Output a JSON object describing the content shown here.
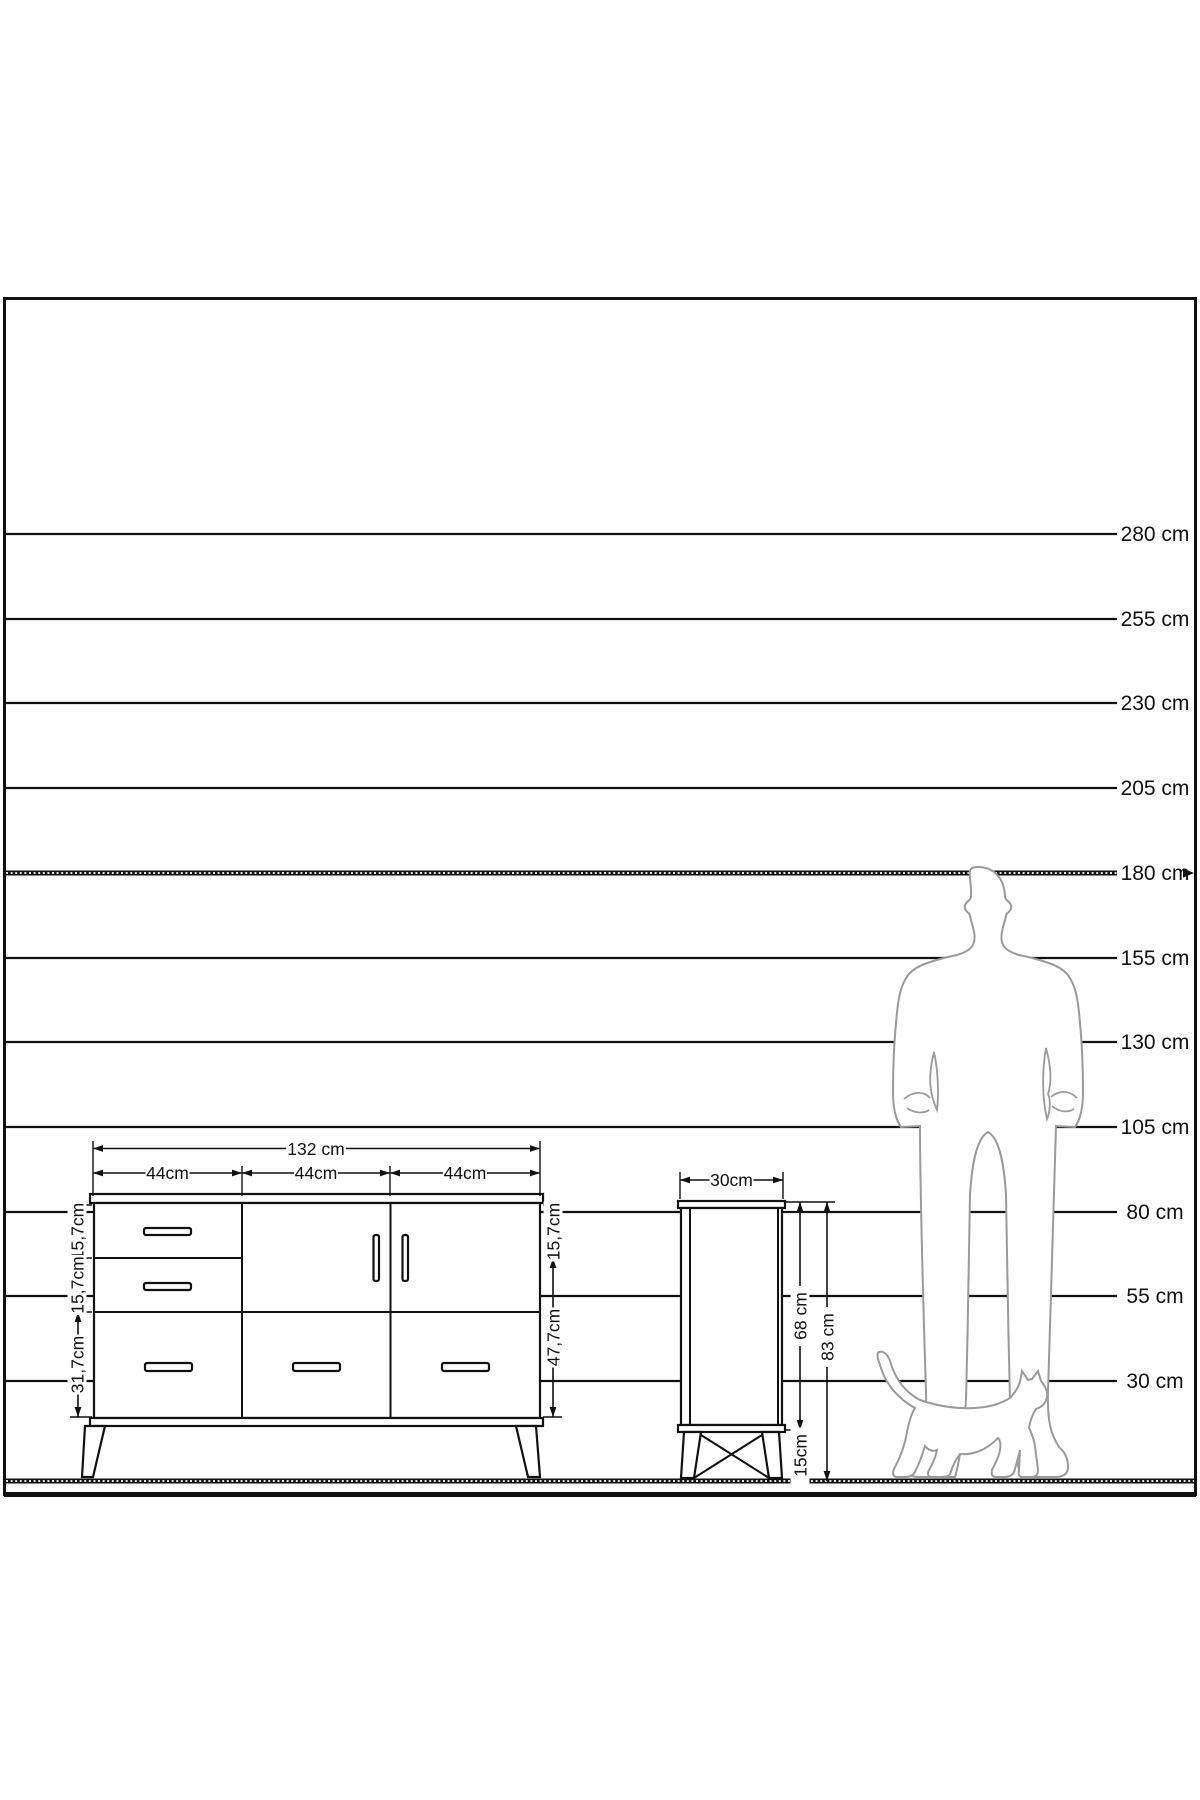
{
  "scale": {
    "labels": [
      "280 cm",
      "255 cm",
      "230 cm",
      "205 cm",
      "180 cm",
      "155 cm",
      "130 cm",
      "105 cm",
      "80 cm",
      "55 cm",
      "30 cm"
    ],
    "highlighted_label": "180 cm"
  },
  "sideboard": {
    "width_label": "132 cm",
    "section_width_labels": [
      "44cm",
      "44cm",
      "44cm"
    ],
    "left_height_labels": [
      "15,7cm",
      "15,7cm",
      "31,7cm"
    ],
    "right_height_labels": [
      "15,7cm",
      "47,7cm"
    ]
  },
  "cabinet": {
    "depth_label": "30cm",
    "body_height_label": "68 cm",
    "total_height_label": "83 cm",
    "leg_height_label": "15cm"
  },
  "colors": {
    "line": "#111111",
    "silhouette": "#9a9a9a",
    "background": "#ffffff"
  }
}
